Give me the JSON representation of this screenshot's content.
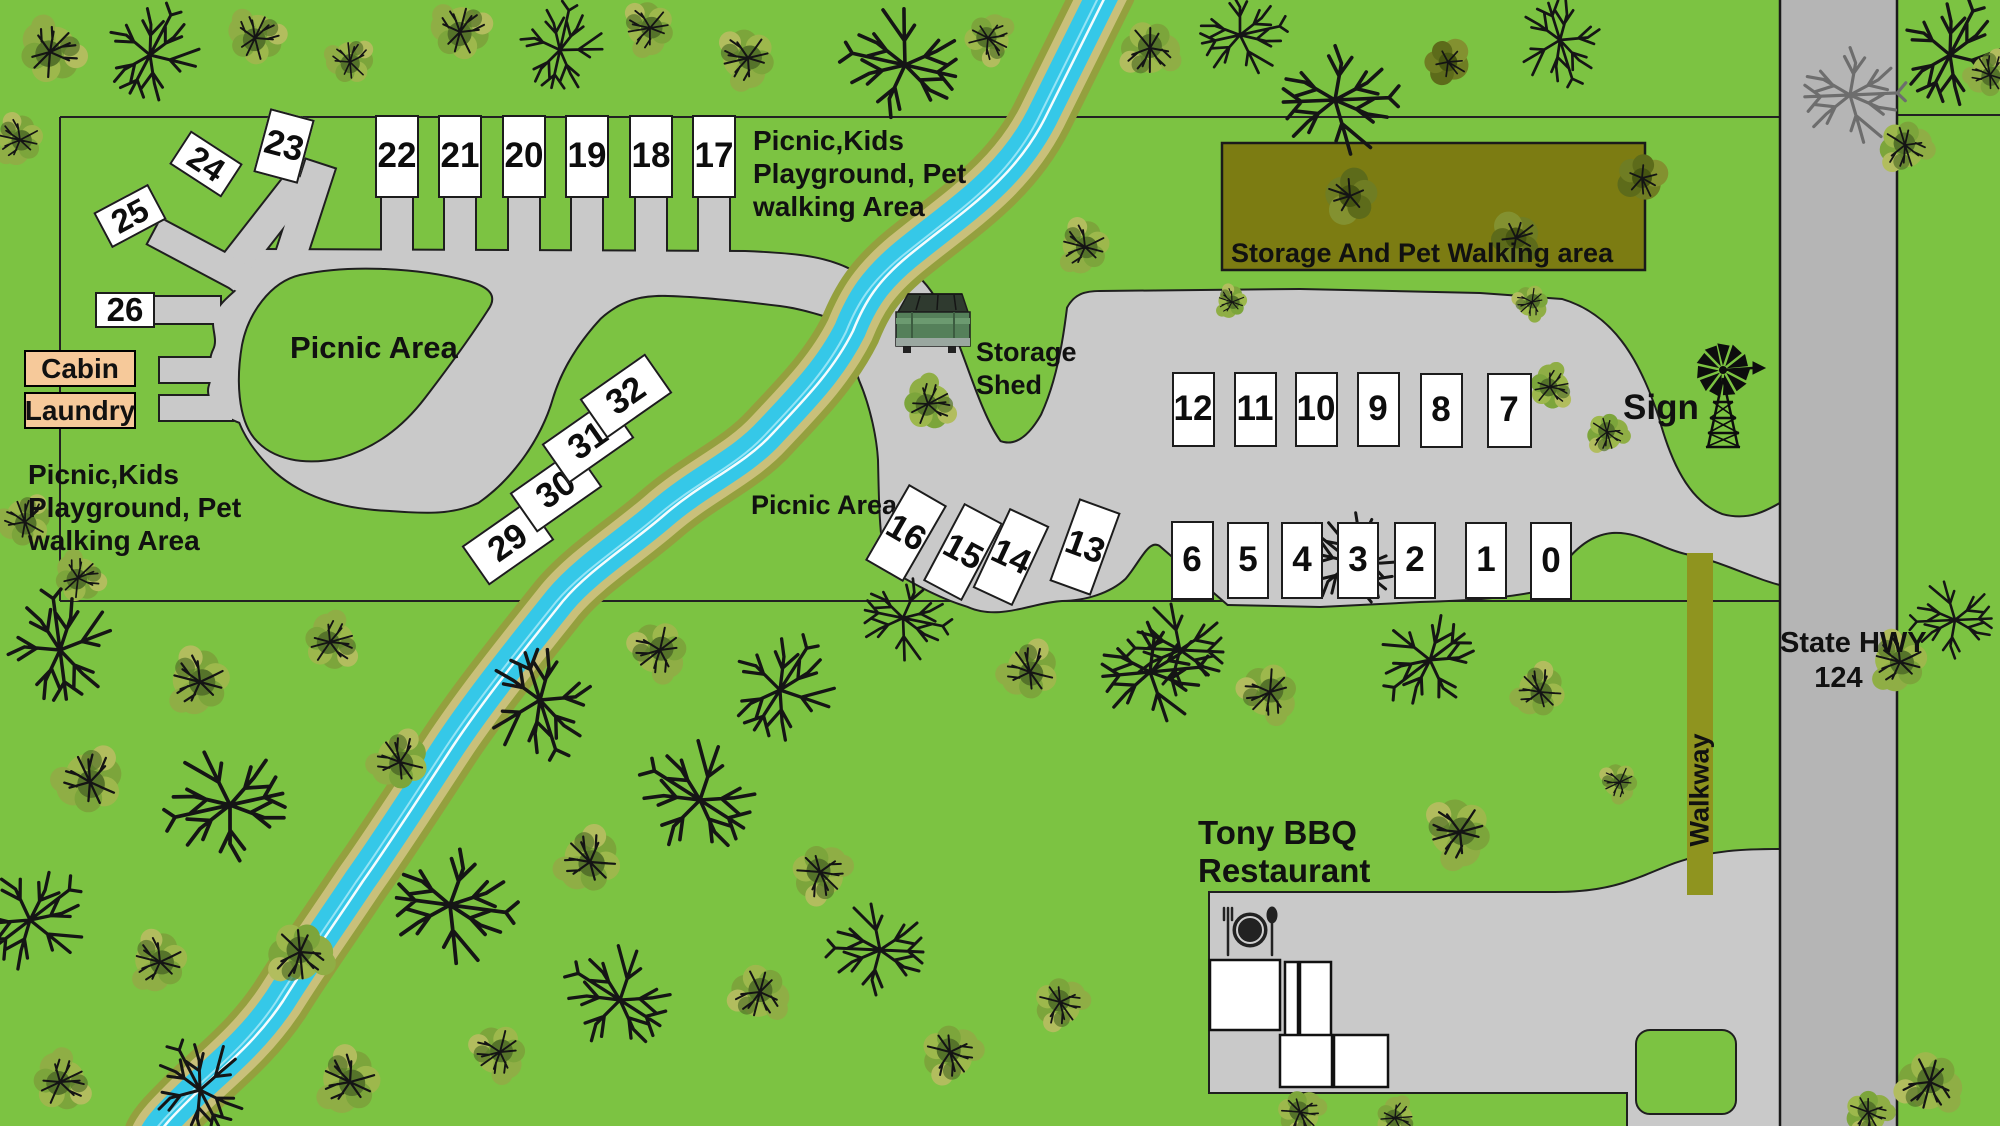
{
  "map_type": "campground-site-map",
  "labels": {
    "area_note_top": [
      "Picnic,Kids",
      "Playground, Pet",
      "walking Area"
    ],
    "area_note_left": [
      "Picnic,Kids",
      "Playground, Pet",
      "walking Area"
    ],
    "picnic_area_upper": "Picnic Area",
    "picnic_area_lower": "Picnic Area",
    "storage_shed": [
      "Storage",
      "Shed"
    ],
    "storage_pet_area": "Storage And Pet Walking area",
    "sign": "Sign",
    "walkway": "Walkway",
    "highway": [
      "State HWY",
      "124"
    ],
    "restaurant": [
      "Tony BBQ",
      "Restaurant"
    ],
    "cabin": "Cabin",
    "laundry": "Laundry"
  },
  "sites": {
    "top_row": [
      "22",
      "21",
      "20",
      "19",
      "18",
      "17"
    ],
    "fan_row": [
      "25",
      "24",
      "23"
    ],
    "west_single": [
      "26"
    ],
    "creek_diagonal": [
      "29",
      "30",
      "31",
      "32"
    ],
    "mid_tilted": [
      "16",
      "15",
      "14",
      "13"
    ],
    "east_upper_row": [
      "12",
      "11",
      "10",
      "9",
      "8",
      "7"
    ],
    "east_lower_row": [
      "6",
      "5",
      "4",
      "3",
      "2",
      "1",
      "0"
    ]
  },
  "icons": {
    "sign": "windmill-icon",
    "storage_shed": "dumpster-icon",
    "restaurant": "cutlery-plate-icon",
    "vegetation": [
      "bare-tree-icon",
      "bushy-tree-icon"
    ]
  },
  "colors": {
    "grass": "#7cc342",
    "road": "#c9c9c9",
    "highway": "#b5b5b5",
    "water": "#35c8e8",
    "creek_bank_outer": "#94a03e",
    "creek_bank_inner": "#c9c07a",
    "storage_area": "#7c7c12",
    "walkway": "#8f941f",
    "site_fill": "#ffffff",
    "cabin_fill": "#f6c99a",
    "outline": "#1f1f1f"
  }
}
